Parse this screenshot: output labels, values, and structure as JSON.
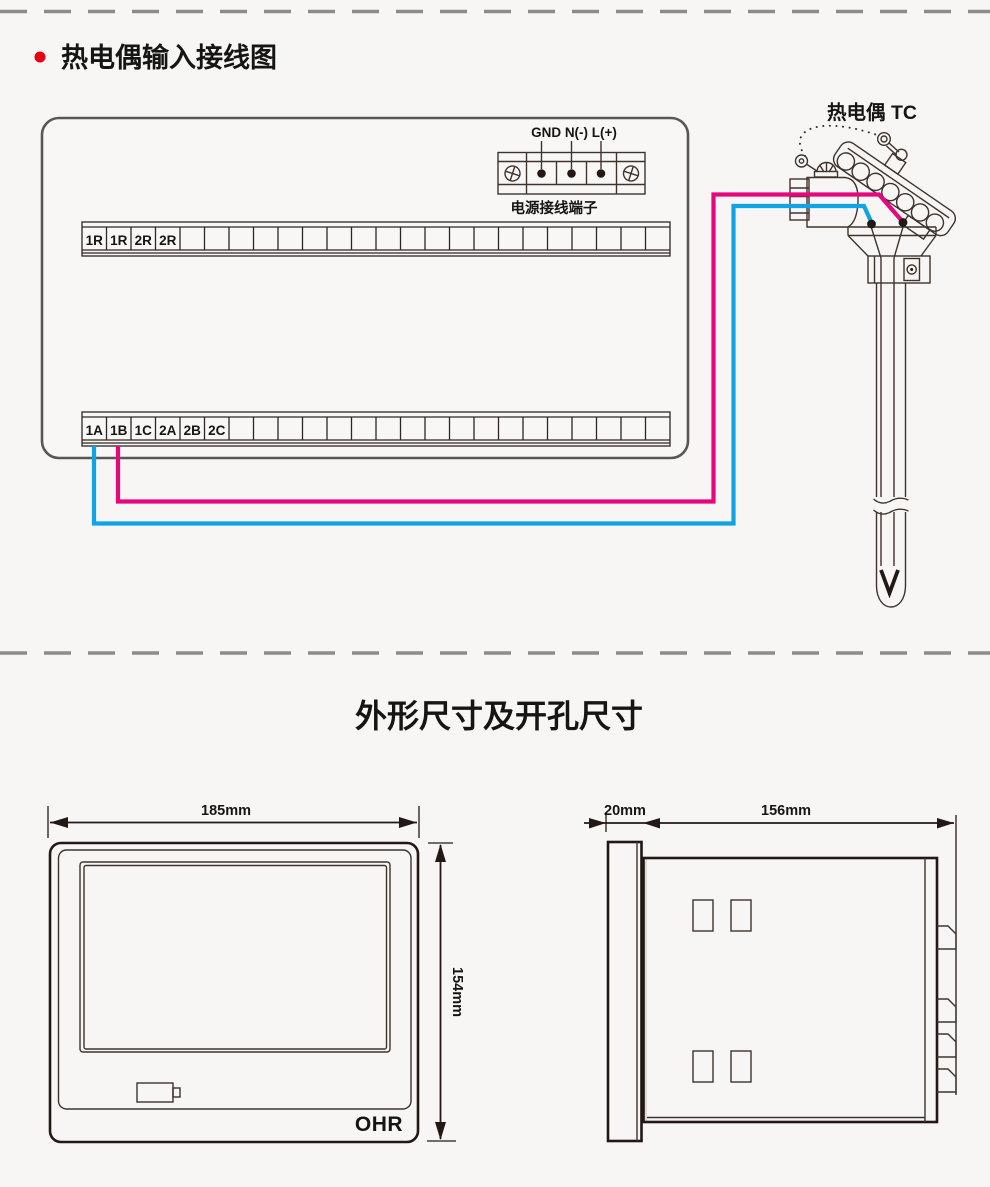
{
  "section1": {
    "bullet_color": "#e60012",
    "title": "热电偶输入接线图",
    "power_terminal": {
      "pins_label": "GND N(-) L(+)",
      "caption": "电源接线端子"
    },
    "upper_strip": {
      "cells": 24,
      "labels": [
        "1R",
        "1R",
        "2R",
        "2R"
      ]
    },
    "lower_strip": {
      "cells": 24,
      "labels": [
        "1A",
        "1B",
        "1C",
        "2A",
        "2B",
        "2C"
      ]
    },
    "thermocouple_label": "热电偶 TC",
    "wire_colors": {
      "positive": "#e5077e",
      "negative": "#10a3e6"
    }
  },
  "section2": {
    "title": "外形尺寸及开孔尺寸",
    "front_view": {
      "width_label": "185mm",
      "height_label": "154mm",
      "logo": "OHR"
    },
    "side_view": {
      "depth_label": "20mm",
      "body_label": "156mm"
    }
  }
}
